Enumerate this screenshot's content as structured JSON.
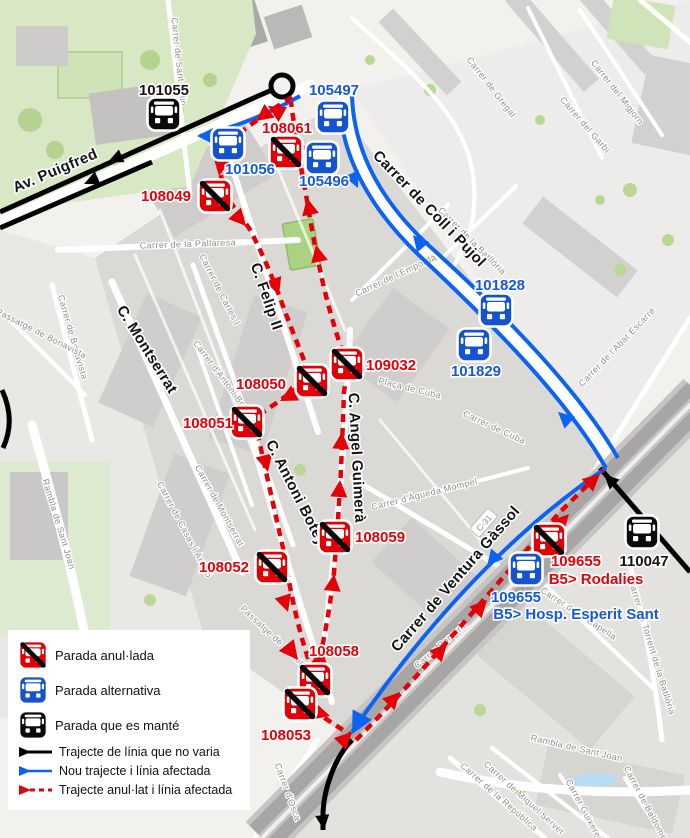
{
  "map_title": "Mapa d'afectació de línia de bus",
  "colors": {
    "stop_cancelled": "#e30005",
    "stop_alternative": "#1353d0",
    "stop_maintained": "#0a0a0a",
    "route_unchanged": "#000000",
    "route_new": "#0c63f3",
    "route_cancelled": "#e50007"
  },
  "stops": {
    "s101055": "101055",
    "s105497": "105497",
    "s101056": "101056",
    "s108061": "108061",
    "s105496": "105496",
    "s108049": "108049",
    "s101828": "101828",
    "s101829": "101829",
    "s109032": "109032",
    "s108050": "108050",
    "s108051": "108051",
    "s108059": "108059",
    "s108052": "108052",
    "s109655_cancelled": "109655",
    "s109655_alternative": "109655",
    "s110047": "110047",
    "s108058": "108058",
    "s108053": "108053",
    "b5_rodalies": "B5> Rodalies",
    "b5_hosp": "B5> Hosp. Esperit Sant"
  },
  "streets": {
    "av_puigfred": "Av. Puigfred",
    "c_felip": "C. Felip II",
    "c_montserrat": "C. Montserrat",
    "coll_pujol": "Carrer de Coll i Pujol",
    "ventura_gassol": "Carrer de Ventura Gàssol",
    "angel_guimera": "C. Angel Guimerà",
    "antoni_botey": "C. Antoni Botey",
    "sant_felip": "Carrer de Sant Felip",
    "pallaresa": "Carrer de la Pallaresa",
    "bonavista": "Carrer de Bonavista",
    "pg_bonavista": "Passatge de Bonavista",
    "carles_i": "Carrer de Carles I",
    "antoni_bori": "Carrer d'Antoni Bori",
    "gregal": "Carrer de Gregal",
    "garbi": "Carrer del Garbí",
    "migjorn": "Carrer del Migjorn",
    "emporda": "Carrer de l'Empordà",
    "batlloria": "Carrer de la Batllòria",
    "abat_escarre": "Carrer de l'Abat Escarré",
    "placa_cuba": "Plaça de Cuba",
    "cuba": "Carrer de Cuba",
    "agueda": "Carrer d'Àgueda Mompel",
    "rambla_sant_joan": "Rambla de Sant Joan",
    "casas_amigo": "Carrer de Casas i Amigó",
    "montserrat_minor": "Carrer de Montserrat",
    "pg_fortuny": "Passatge de Fortuny",
    "porvenir": "Carrer Porvenir",
    "osca": "Carrer d'Osca",
    "miquel_servet": "Carrer de Miquel Servet",
    "republica": "Carrer de la República",
    "rambla_sant_joan_2": "Rambla de Sant Joan",
    "guixeres": "Carrer Guixeres",
    "baldomer": "Carrer de Baldomer Solà",
    "torrent_batlloria": "Carrer del Torrent de la Batllòria",
    "capella": "Carrer de la Capella",
    "c31": "C-31"
  },
  "legend": {
    "items": [
      {
        "icon": "cancelled-stop-icon",
        "label": "Parada anul·lada"
      },
      {
        "icon": "alternative-stop-icon",
        "label": "Parada alternativa"
      },
      {
        "icon": "maintained-stop-icon",
        "label": "Parada que es manté"
      },
      {
        "icon": "unchanged-route-line",
        "label": "Trajecte de línia que no varia"
      },
      {
        "icon": "new-route-line",
        "label": "Nou trajecte i línia afectada"
      },
      {
        "icon": "cancelled-route-line",
        "label": "Trajecte anul·lat i línia afectada"
      }
    ]
  }
}
